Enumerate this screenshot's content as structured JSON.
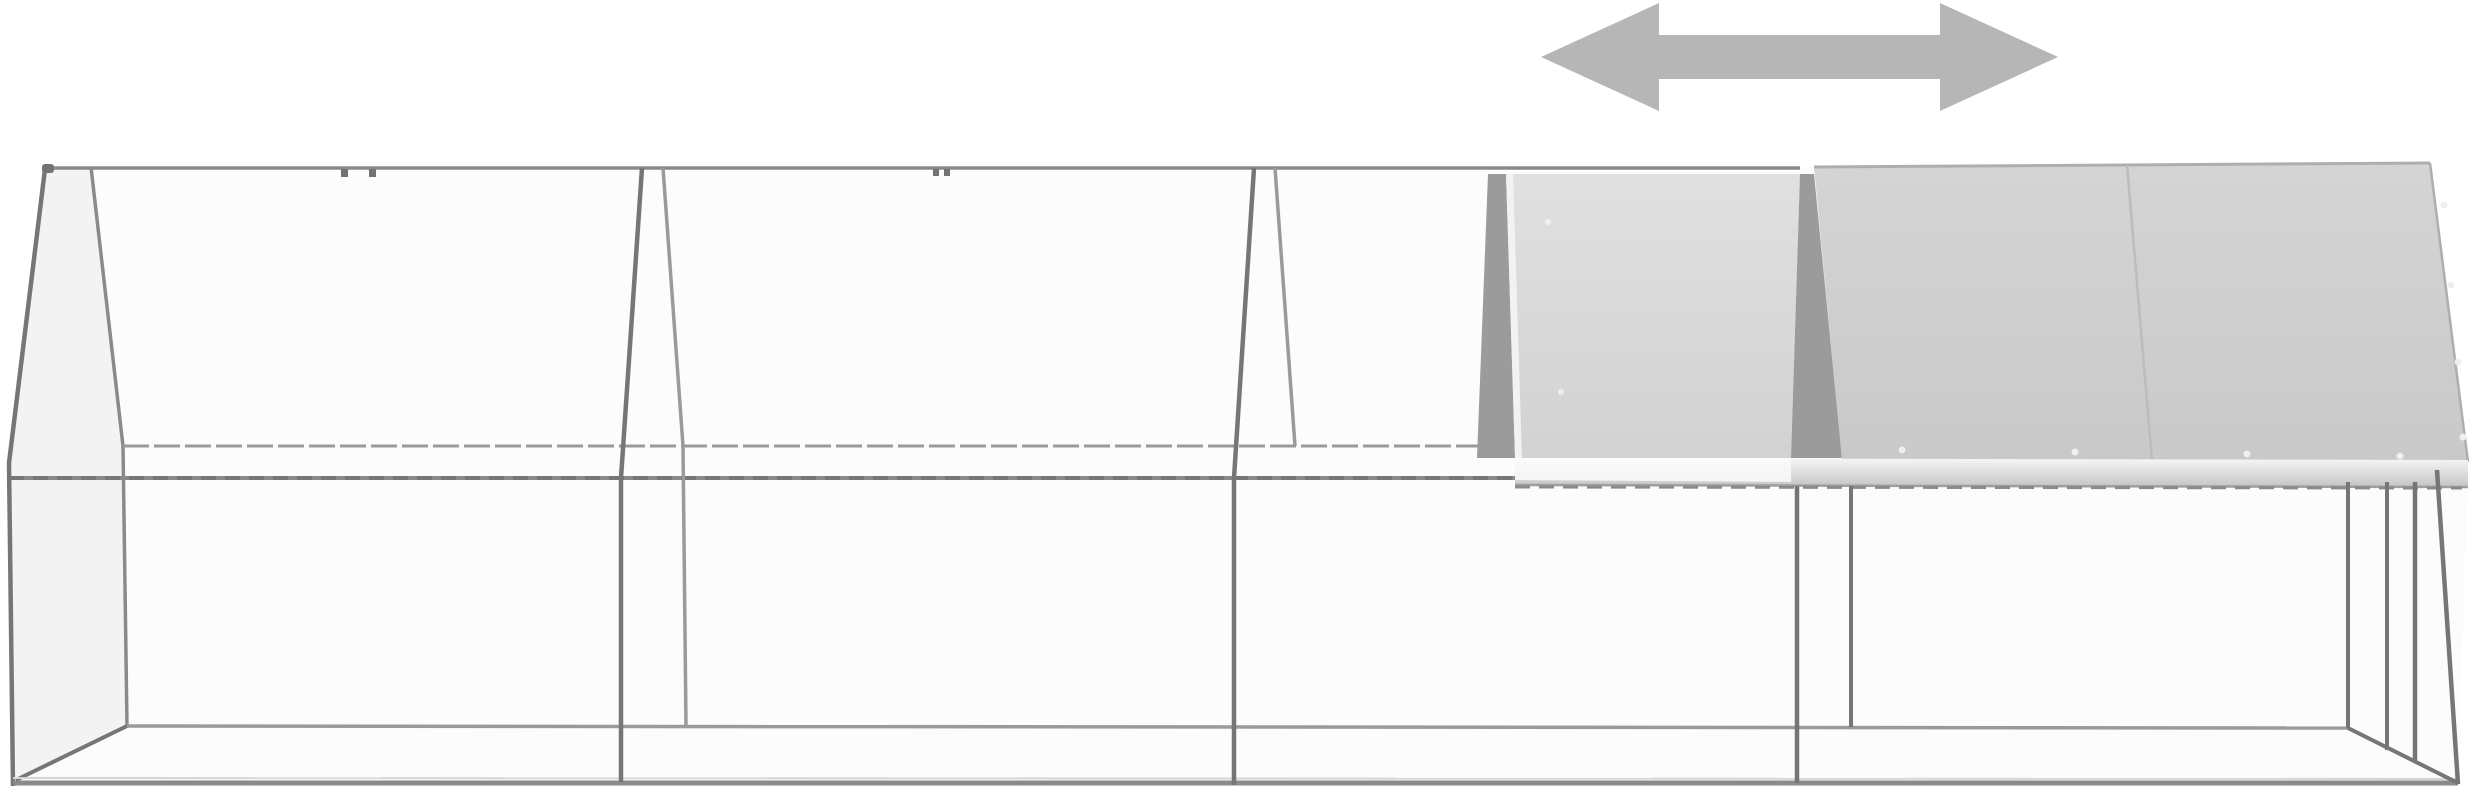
{
  "image": {
    "description": "Product image of a long galvanised-steel walk-in chicken run (poultry cage) with wire mesh sides, pitched roof, four bays; the right half of the roof carries grey covers and a horizontal double arrow shows that the roof cover slides sideways",
    "visible_text": "",
    "background": "#ffffff"
  },
  "cage": {
    "bays": 4,
    "roof_covered_bays": 2,
    "sliding_roof_panel": true,
    "rivet_count": 10,
    "ridge_clamp_count": 4
  },
  "arrow_annotation": {
    "shape": "double-headed horizontal arrow",
    "meaning": "roof cover slides left-right along the run"
  },
  "colors": {
    "background": "#ffffff",
    "frame_dark": "#767676",
    "frame_mid": "#8a8a8a",
    "frame_light": "#9a9a9a",
    "silhouette_tint": "#fcfcfc",
    "gable_tint": "#f3f3f3",
    "wedge_gray": "#9b9b9b",
    "cover_sliding_top": "#e0e0e0",
    "cover_sliding_bottom": "#d2d2d2",
    "cover_fixed_top": "#d4d4d4",
    "cover_fixed_bottom": "#c9c9c9",
    "cover_edge": "#aeaeae",
    "seam_gray": "#bcbcbc",
    "eave_bar_top": "#f7f7f7",
    "eave_bar_bottom": "#c6c6c6",
    "eave_bar_bright": "#fafafa",
    "rivet_fill": "#efefef",
    "rivet_stroke": "#b5b5b5",
    "clamp_gray": "#737373",
    "arrow_gray": "#b6b6b6"
  }
}
